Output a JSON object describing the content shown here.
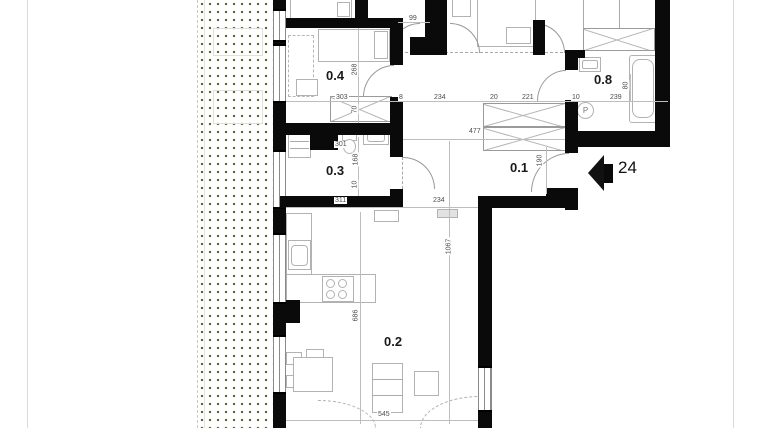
{
  "plan": {
    "rooms": [
      "0.4",
      "0.3",
      "0.2",
      "0.1",
      "0.8"
    ],
    "dims_h": [
      "99",
      "303",
      "8",
      "234",
      "20",
      "221",
      "10",
      "239",
      "477",
      "301",
      "311",
      "234",
      "545"
    ],
    "dims_v": [
      "268",
      "70",
      "168",
      "10",
      "686",
      "190",
      "1067",
      "80"
    ],
    "entrance": {
      "number": "24"
    },
    "fixtures": {
      "washer_letter": "P"
    }
  },
  "colors": {
    "wall": "#0a0a0a",
    "terrace_dot_green": "#55682e",
    "thin_line": "#b2b2b2",
    "dim_text": "#4d4d4d"
  }
}
